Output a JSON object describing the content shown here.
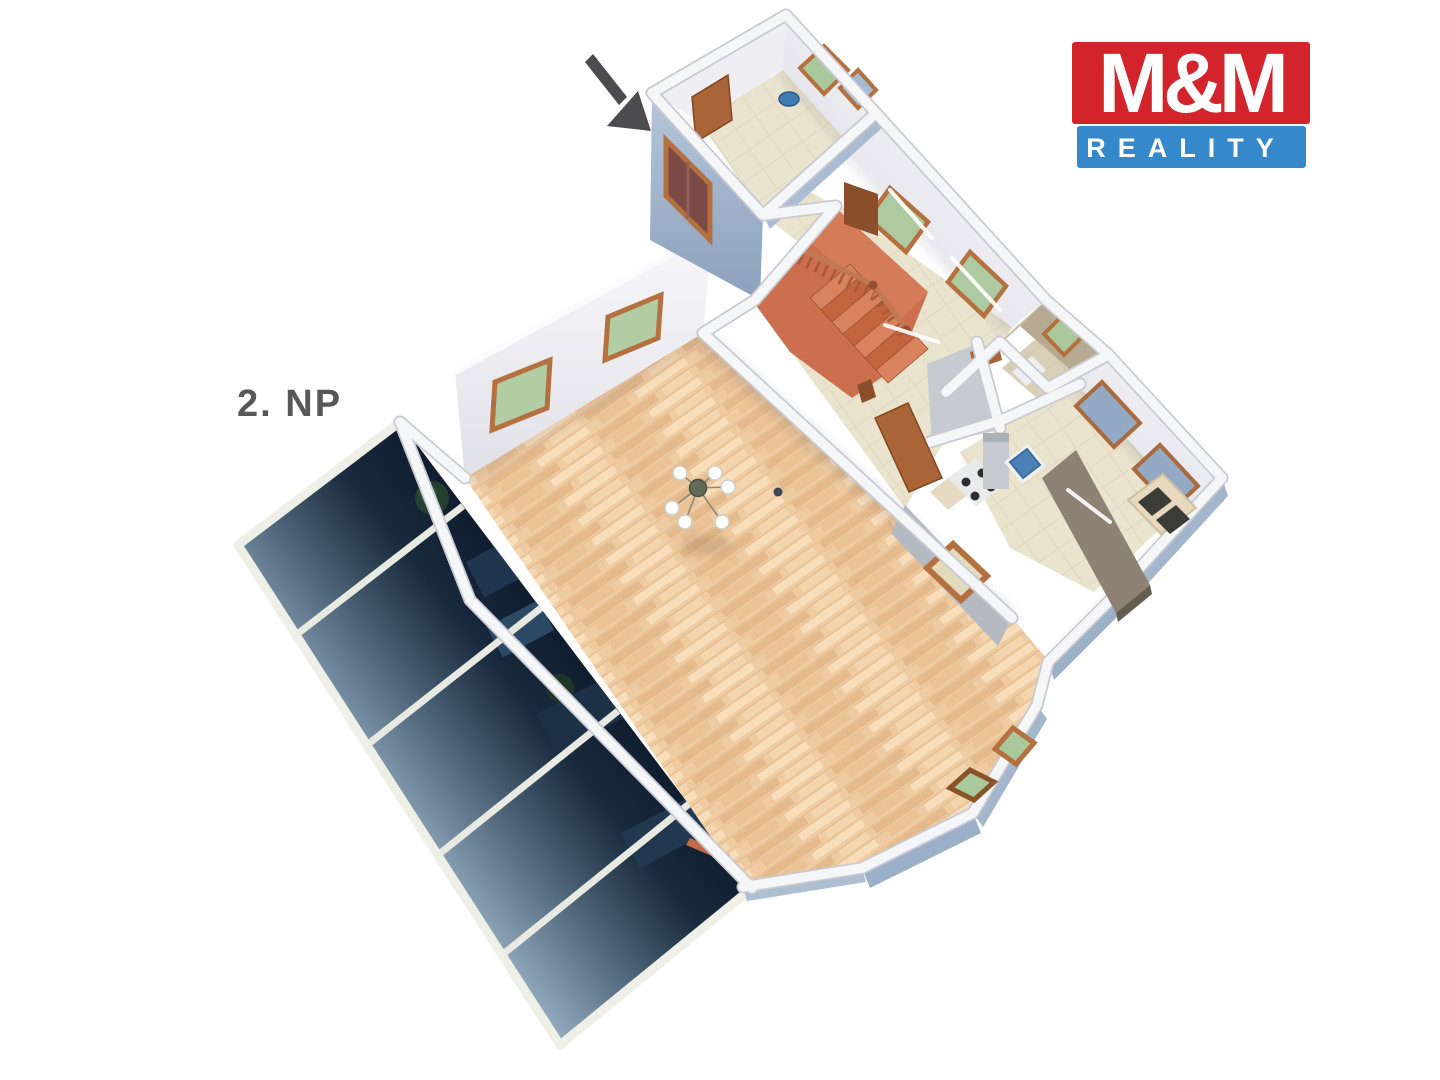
{
  "scene": {
    "description": "3D rendered floor plan of the second floor of a house, viewed from above at an angle",
    "background": "#ffffff"
  },
  "floor_label": {
    "text": "2. NP",
    "color": "#58585a"
  },
  "logo": {
    "line1": "M&M",
    "line2": "REALITY",
    "red_bg": "#d3232b",
    "blue_bg": "#3588c9",
    "text_color": "#ffffff"
  },
  "entrance_arrow": {
    "meaning": "points-to-entrance-door",
    "color": "#4c4c4e"
  },
  "palette": {
    "exterior_wall_blue": "#a7bad0",
    "interior_wall_white": "#f5f6f8",
    "wall_edge_gray": "#c9c9d1",
    "parquet_floor": "#efcba1",
    "tile_floor_beige": "#eae3cd",
    "bathroom_wall_tan": "#b6aa92",
    "stair_terracotta": "#cb6f4e",
    "window_green": "#aecaa0",
    "window_blue": "#a3bcd6",
    "wood_frame": "#b4713f",
    "glass_roof_dark": "#0a1524",
    "glass_roof_light": "#92a9be",
    "kitchen_counter": "#8d8273",
    "sink_blue": "#4a80b6"
  },
  "rooms": [
    {
      "name": "living-room",
      "floor": "parquet",
      "features": [
        "chandelier",
        "bay-window",
        "green-windows"
      ]
    },
    {
      "name": "entry-room",
      "floor": "tile",
      "features": [
        "entrance-door",
        "green-window",
        "glass-door",
        "round-mirror"
      ]
    },
    {
      "name": "staircase-room",
      "floor": "terracotta",
      "features": [
        "u-shaped-stair",
        "wood-railing",
        "green-windows"
      ]
    },
    {
      "name": "hallway",
      "floor": "tile",
      "features": [
        "open-door"
      ]
    },
    {
      "name": "bathroom",
      "floor": "tile",
      "features": [
        "green-window"
      ]
    },
    {
      "name": "kitchen",
      "floor": "tile",
      "features": [
        "sink",
        "stove",
        "island-counter",
        "wall-cabinets"
      ]
    },
    {
      "name": "glass-roof-atrium",
      "floor": "glass-panels-over-lower-floor",
      "features": [
        "furniture-below",
        "plants-below"
      ]
    }
  ]
}
